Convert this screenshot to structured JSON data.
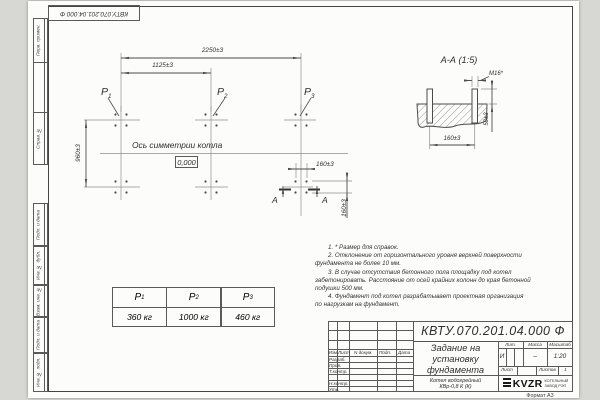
{
  "stamp": {
    "doc_number_rotated": "КВТУ.070.201.04.000  Ф"
  },
  "margin": {
    "labels": [
      "Перв. примен.",
      "Справ. №",
      "Подп. и дата",
      "Инв. № дубл.",
      "Взам. инв. №",
      "Подп. и дата",
      "Инв. № подл."
    ]
  },
  "plan": {
    "dim_overall": "2250±3",
    "dim_half": "1125±3",
    "dim_depth": "960±3",
    "dim_bolt_h": "160±3",
    "dim_bolt_v": "160±3",
    "axis_label": "Ось симметрии котла",
    "level_mark": "0,000",
    "p_labels": [
      {
        "name": "P",
        "sub": "1"
      },
      {
        "name": "P",
        "sub": "2"
      },
      {
        "name": "P",
        "sub": "3"
      }
    ],
    "cut_letter_left": "А",
    "cut_letter_right": "А"
  },
  "section": {
    "title": "А-А (1:5)",
    "bolt_label": "М16*",
    "dim_height": "50±3",
    "dim_spacing": "160±3"
  },
  "notes": [
    "1. * Размер для справок.",
    "2. Отклонение от горизонтального уровня верхней поверхности",
    "фундамента не более 10 мм.",
    "3. В случае отсутствия бетонного пола площадку под котел",
    "забетонировать. Расстояние от осей крайних колонн до края бетонной",
    "подушки 500 мм.",
    "4. Фундамент под котел разрабатывает проектная организация",
    "по нагрузкам на фундамент."
  ],
  "load_table": {
    "headers": [
      {
        "name": "P",
        "sub": "1"
      },
      {
        "name": "P",
        "sub": "2"
      },
      {
        "name": "P",
        "sub": "3"
      }
    ],
    "values": [
      "360 кг",
      "1000 кг",
      "460 кг"
    ]
  },
  "title_block": {
    "doc_number": "КВТУ.070.201.04.000  Ф",
    "title_line1": "Задание на",
    "title_line2": "установку",
    "title_line3": "фундамента",
    "product_line1": "Котел водогрейный",
    "product_line2": "КВр-0,8 К (К)",
    "col_izm": "Изм.",
    "col_list": "Лист",
    "col_docnum": "N докум.",
    "col_podp": "Подп.",
    "col_data": "Дата",
    "row_razrab": "Разраб.",
    "row_prov": "Пров.",
    "row_tkontr": "Т.контр.",
    "row_nkontr": "Н.контр.",
    "row_utv": "Утв.",
    "lit_label": "Лит.",
    "mass_label": "Масса",
    "scale_label": "Масштаб",
    "lit_value": "И",
    "mass_value": "–",
    "scale_value": "1:20",
    "sheet_label": "Лист",
    "sheets_label": "Листов",
    "sheets_value": "1",
    "logo_text": "KVZR",
    "logo_sub1": "КОТЕЛЬНЫЙ",
    "logo_sub2": "ЗАВОД РЭП",
    "format_note": "Формат А3"
  },
  "colors": {
    "line": "#4d4d4d",
    "thin_line": "#8f8f8f",
    "paper": "#fcfcfa"
  }
}
